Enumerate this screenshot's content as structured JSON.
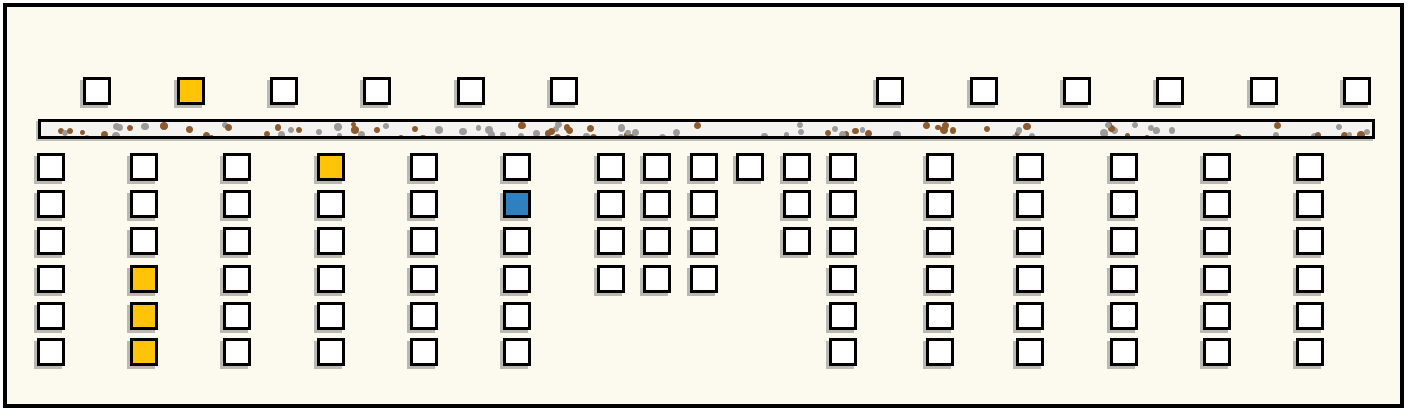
{
  "scene": {
    "canvas": {
      "width": 1408,
      "height": 412,
      "outer_background": "#ffffff",
      "background": "#FCFAEE",
      "frame_color": "#000000"
    },
    "road": {
      "x": 38,
      "y": 119,
      "width": 1337,
      "height": 20,
      "surface_color": "#F5F3EF",
      "border_color": "#000000",
      "gravel_gray": "#9B9B9B",
      "gravel_brown": "#8E5B2F",
      "gravel_dot_count": 135
    },
    "square_style": {
      "size": 28,
      "border_width": 3,
      "border_color": "#000000",
      "shadow_color": "#828282",
      "fills": {
        "white": "#FFFFFF",
        "yellow": "#FFC408",
        "blue": "#2F80BE"
      }
    },
    "top_row": {
      "y": 77,
      "squares": [
        {
          "x": 83,
          "fill": "white"
        },
        {
          "x": 177,
          "fill": "yellow"
        },
        {
          "x": 270,
          "fill": "white"
        },
        {
          "x": 363,
          "fill": "white"
        },
        {
          "x": 457,
          "fill": "white"
        },
        {
          "x": 550,
          "fill": "white"
        },
        {
          "x": 876,
          "fill": "white"
        },
        {
          "x": 970,
          "fill": "white"
        },
        {
          "x": 1063,
          "fill": "white"
        },
        {
          "x": 1156,
          "fill": "white"
        },
        {
          "x": 1250,
          "fill": "white"
        },
        {
          "x": 1343,
          "fill": "white"
        }
      ]
    },
    "grid": {
      "row_y": [
        153,
        190,
        227,
        265,
        302,
        338
      ],
      "columns": [
        {
          "x": 37,
          "cells": [
            {
              "row": 1,
              "fill": "white"
            },
            {
              "row": 2,
              "fill": "white"
            },
            {
              "row": 3,
              "fill": "white"
            },
            {
              "row": 4,
              "fill": "white"
            },
            {
              "row": 5,
              "fill": "white"
            },
            {
              "row": 6,
              "fill": "white"
            }
          ]
        },
        {
          "x": 130,
          "cells": [
            {
              "row": 1,
              "fill": "white"
            },
            {
              "row": 2,
              "fill": "white"
            },
            {
              "row": 3,
              "fill": "white"
            },
            {
              "row": 4,
              "fill": "yellow"
            },
            {
              "row": 5,
              "fill": "yellow"
            },
            {
              "row": 6,
              "fill": "yellow"
            }
          ]
        },
        {
          "x": 223,
          "cells": [
            {
              "row": 1,
              "fill": "white"
            },
            {
              "row": 2,
              "fill": "white"
            },
            {
              "row": 3,
              "fill": "white"
            },
            {
              "row": 4,
              "fill": "white"
            },
            {
              "row": 5,
              "fill": "white"
            },
            {
              "row": 6,
              "fill": "white"
            }
          ]
        },
        {
          "x": 317,
          "cells": [
            {
              "row": 1,
              "fill": "yellow"
            },
            {
              "row": 2,
              "fill": "white"
            },
            {
              "row": 3,
              "fill": "white"
            },
            {
              "row": 4,
              "fill": "white"
            },
            {
              "row": 5,
              "fill": "white"
            },
            {
              "row": 6,
              "fill": "white"
            }
          ]
        },
        {
          "x": 410,
          "cells": [
            {
              "row": 1,
              "fill": "white"
            },
            {
              "row": 2,
              "fill": "white"
            },
            {
              "row": 3,
              "fill": "white"
            },
            {
              "row": 4,
              "fill": "white"
            },
            {
              "row": 5,
              "fill": "white"
            },
            {
              "row": 6,
              "fill": "white"
            }
          ]
        },
        {
          "x": 503,
          "cells": [
            {
              "row": 1,
              "fill": "white"
            },
            {
              "row": 2,
              "fill": "blue"
            },
            {
              "row": 3,
              "fill": "white"
            },
            {
              "row": 4,
              "fill": "white"
            },
            {
              "row": 5,
              "fill": "white"
            },
            {
              "row": 6,
              "fill": "white"
            }
          ]
        },
        {
          "x": 597,
          "cells": [
            {
              "row": 1,
              "fill": "white"
            },
            {
              "row": 2,
              "fill": "white"
            },
            {
              "row": 3,
              "fill": "white"
            },
            {
              "row": 4,
              "fill": "white"
            }
          ]
        },
        {
          "x": 643,
          "cells": [
            {
              "row": 1,
              "fill": "white"
            },
            {
              "row": 2,
              "fill": "white"
            },
            {
              "row": 3,
              "fill": "white"
            },
            {
              "row": 4,
              "fill": "white"
            }
          ]
        },
        {
          "x": 690,
          "cells": [
            {
              "row": 1,
              "fill": "white"
            },
            {
              "row": 2,
              "fill": "white"
            },
            {
              "row": 3,
              "fill": "white"
            },
            {
              "row": 4,
              "fill": "white"
            }
          ]
        },
        {
          "x": 736,
          "cells": [
            {
              "row": 1,
              "fill": "white"
            }
          ]
        },
        {
          "x": 783,
          "cells": [
            {
              "row": 1,
              "fill": "white"
            },
            {
              "row": 2,
              "fill": "white"
            },
            {
              "row": 3,
              "fill": "white"
            }
          ]
        },
        {
          "x": 829,
          "cells": [
            {
              "row": 1,
              "fill": "white"
            },
            {
              "row": 2,
              "fill": "white"
            },
            {
              "row": 3,
              "fill": "white"
            },
            {
              "row": 4,
              "fill": "white"
            },
            {
              "row": 5,
              "fill": "white"
            },
            {
              "row": 6,
              "fill": "white"
            }
          ]
        },
        {
          "x": 926,
          "cells": [
            {
              "row": 1,
              "fill": "white"
            },
            {
              "row": 2,
              "fill": "white"
            },
            {
              "row": 3,
              "fill": "white"
            },
            {
              "row": 4,
              "fill": "white"
            },
            {
              "row": 5,
              "fill": "white"
            },
            {
              "row": 6,
              "fill": "white"
            }
          ]
        },
        {
          "x": 1016,
          "cells": [
            {
              "row": 1,
              "fill": "white"
            },
            {
              "row": 2,
              "fill": "white"
            },
            {
              "row": 3,
              "fill": "white"
            },
            {
              "row": 4,
              "fill": "white"
            },
            {
              "row": 5,
              "fill": "white"
            },
            {
              "row": 6,
              "fill": "white"
            }
          ]
        },
        {
          "x": 1110,
          "cells": [
            {
              "row": 1,
              "fill": "white"
            },
            {
              "row": 2,
              "fill": "white"
            },
            {
              "row": 3,
              "fill": "white"
            },
            {
              "row": 4,
              "fill": "white"
            },
            {
              "row": 5,
              "fill": "white"
            },
            {
              "row": 6,
              "fill": "white"
            }
          ]
        },
        {
          "x": 1203,
          "cells": [
            {
              "row": 1,
              "fill": "white"
            },
            {
              "row": 2,
              "fill": "white"
            },
            {
              "row": 3,
              "fill": "white"
            },
            {
              "row": 4,
              "fill": "white"
            },
            {
              "row": 5,
              "fill": "white"
            },
            {
              "row": 6,
              "fill": "white"
            }
          ]
        },
        {
          "x": 1296,
          "cells": [
            {
              "row": 1,
              "fill": "white"
            },
            {
              "row": 2,
              "fill": "white"
            },
            {
              "row": 3,
              "fill": "white"
            },
            {
              "row": 4,
              "fill": "white"
            },
            {
              "row": 5,
              "fill": "white"
            },
            {
              "row": 6,
              "fill": "white"
            }
          ]
        }
      ]
    }
  }
}
